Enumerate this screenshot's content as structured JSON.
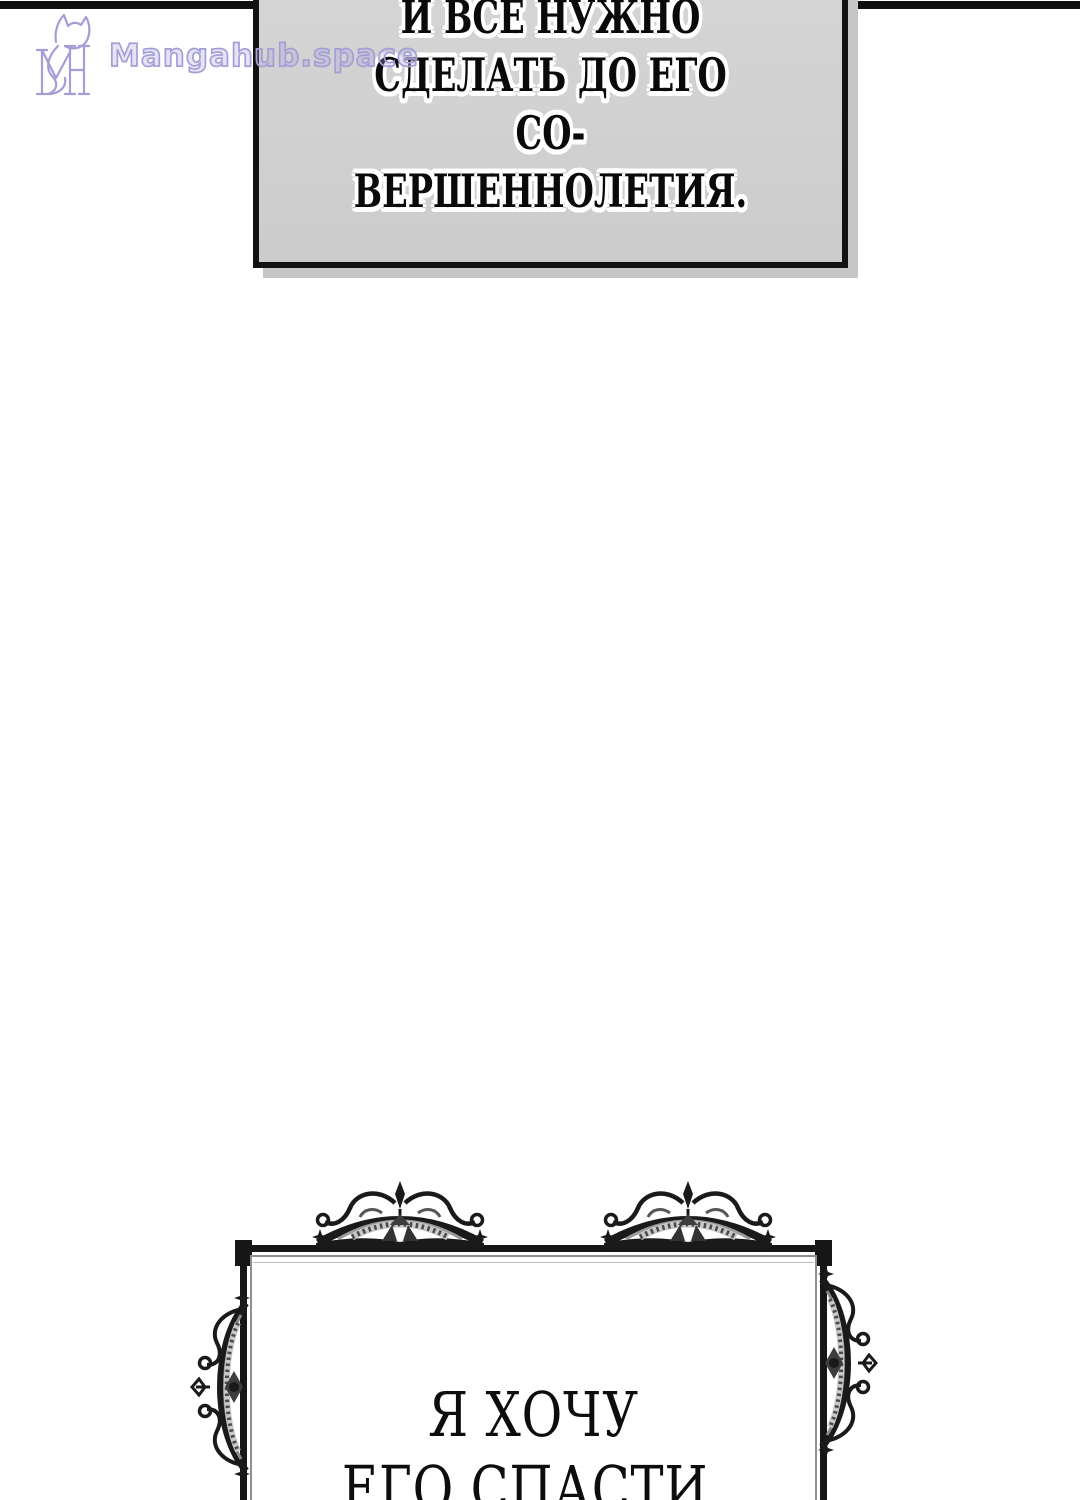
{
  "page": {
    "background": "#ffffff",
    "top_rule_color": "#0e0e0e"
  },
  "watermark": {
    "site_name": "Mangahub.space",
    "monogram": "MH",
    "color": "#a49ed7"
  },
  "speech_bubble": {
    "fill": "#d1d1d1",
    "border_color": "#121212",
    "shadow_color": "#c6c6c6",
    "lines": [
      "И ВСЕ НУЖНО",
      "СДЕЛАТЬ ДО ЕГО СО-",
      "ВЕРШЕННОЛЕТИЯ."
    ]
  },
  "caption_frame": {
    "border_color": "#161616",
    "inner_line_color": "#8f8f8f",
    "lines": [
      "Я ХОЧУ",
      "ЕГО СПАСТИ,"
    ]
  },
  "icons": {
    "logo": "mangahub-fox-monogram",
    "ornament_top": "baroque-crown-flourish",
    "ornament_side": "baroque-scroll-flourish"
  }
}
